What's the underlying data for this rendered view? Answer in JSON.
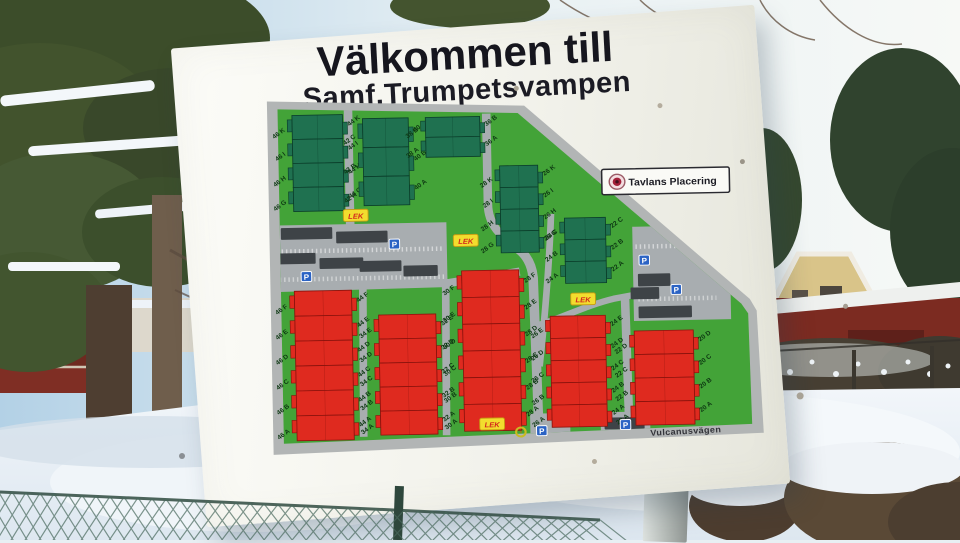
{
  "sign": {
    "title": "Välkommen till",
    "subtitle": "Samf.Trumpetsvampen",
    "placard": {
      "label": "Tavlans Placering"
    },
    "street": "Vulcanusvägen"
  },
  "map": {
    "lek_label": "LEK",
    "parking_label": "P",
    "colors": {
      "field": "#43a338",
      "building_green": "#1f7150",
      "building_red": "#df2a1f",
      "road": "#a8adb0",
      "garage": "#3e4347",
      "lek_bg": "#f2dd2e",
      "lek_text": "#d3281c",
      "parking_bg": "#2b63c4"
    },
    "buildings": [
      {
        "id": "green-1",
        "color": "green",
        "left": [
          "46 K",
          "46 I",
          "46 H",
          "46 G"
        ],
        "right": [
          "44 K",
          "44 I",
          "44 H",
          "44 G"
        ]
      },
      {
        "id": "green-2",
        "color": "green",
        "left": [
          "42 C",
          "42 B",
          "42 A"
        ],
        "right": [
          "40 C",
          "40 B",
          "40 A"
        ]
      },
      {
        "id": "green-3",
        "color": "green",
        "left": [
          "38 B",
          "38 A"
        ],
        "right": [
          "36 B",
          "36 A"
        ]
      },
      {
        "id": "green-4",
        "color": "green",
        "left": [
          "28 K",
          "28 I",
          "28 H",
          "28 G"
        ],
        "right": [
          "26 K",
          "26 I",
          "26 H",
          "26 G"
        ]
      },
      {
        "id": "green-5",
        "color": "green",
        "left": [
          "24 C",
          "24 B",
          "24 A"
        ],
        "right": [
          "22 C",
          "22 B",
          "22 A"
        ]
      },
      {
        "id": "red-1",
        "color": "red",
        "left": [
          "46 F",
          "46 E",
          "46 D",
          "46 C",
          "46 B",
          "46 A"
        ],
        "right": [
          "44 F",
          "44 E",
          "44 D",
          "44 C",
          "44 B",
          "44 A"
        ]
      },
      {
        "id": "red-2",
        "color": "red",
        "left": [
          "34 E",
          "34 D",
          "34 C",
          "34 B",
          "34 A"
        ],
        "right": [
          "32 E",
          "32 D",
          "32 C",
          "32 B",
          "32 A"
        ]
      },
      {
        "id": "red-3",
        "color": "red",
        "left": [
          "30 F",
          "30 E",
          "30 D",
          "30 C",
          "30 B",
          "30 A"
        ],
        "right": [
          "28 F",
          "28 E",
          "28 D",
          "28 C",
          "28 B",
          "28 A"
        ]
      },
      {
        "id": "red-4",
        "color": "red",
        "left": [
          "26 E",
          "26 D",
          "26 C",
          "26 B",
          "26 A"
        ],
        "right": [
          "24 E",
          "24 D",
          "24 C",
          "24 B",
          "24 A"
        ]
      },
      {
        "id": "red-5",
        "color": "red",
        "left": [
          "22 D",
          "22 C",
          "22 B",
          "22 A"
        ],
        "right": [
          "20 D",
          "20 C",
          "20 B",
          "20 A"
        ]
      }
    ]
  }
}
